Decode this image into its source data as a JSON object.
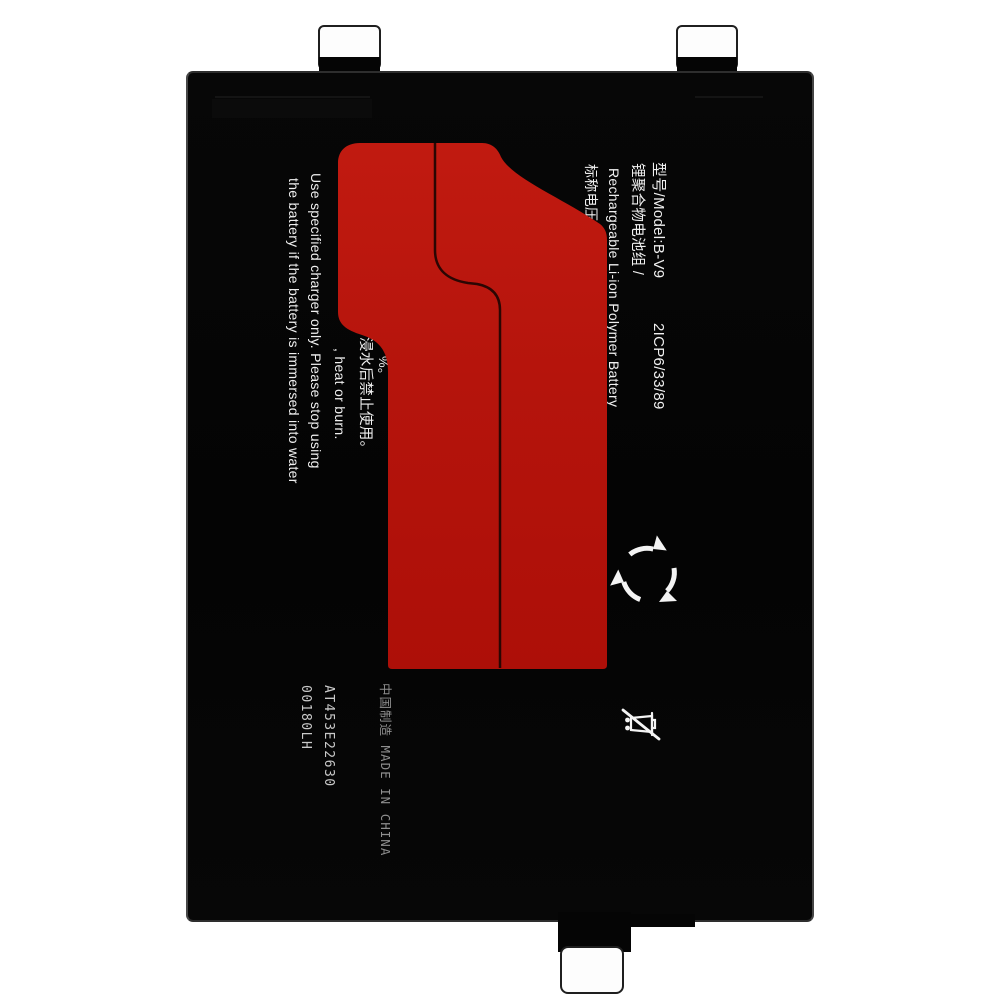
{
  "product_label": {
    "model_line": "型号/Model:B-V9",
    "cell_code": "2ICP6/33/89",
    "type_cn": "锂聚合物电池组 /",
    "type_en": "Rechargeable Li-ion Polymer Battery",
    "voltage_label_cn": "标称电压",
    "warning_cn_partial": "浸水后禁止使用。",
    "warning_en_partial": ", heat or burn.",
    "warning_en_line1": "Use specified charger only. Please stop using",
    "warning_en_line2": "the battery if the battery is immersed into water",
    "fragment_partial": "%。",
    "serial_1": "AT453E22630",
    "serial_2": "00180LH",
    "origin_line": "中国制造 MADE IN CHINA"
  },
  "icons": {
    "recycle": "recycle-icon",
    "no_trash": "crossed-bin-icon"
  },
  "colors": {
    "background": "#ffffff",
    "body_black": "#060606",
    "accent_red_top": "#c11a10",
    "accent_red": "#b5140c",
    "accent_red_bottom": "#ad0f08",
    "seam_line": "#2b0603",
    "label_text": "#f0f0f0",
    "dot_matrix_text": "#c9c9c9",
    "origin_text": "#8f8f8f"
  }
}
